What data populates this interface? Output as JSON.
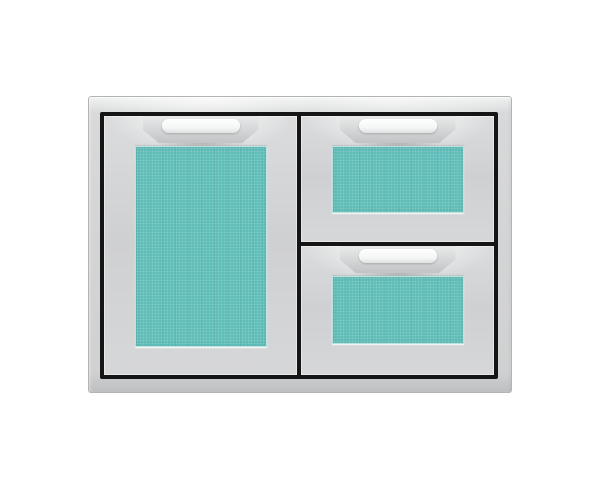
{
  "meta": {
    "type": "product-photo",
    "description": "Stainless steel door and double-drawer storage combo unit with turquoise inset front panels, photographed on a plain white background"
  },
  "colors": {
    "background": "#ffffff",
    "panel_turquoise": "#60bdb8",
    "frame_silver": "#d3d4d5",
    "face_silver": "#d0d1d2",
    "frame_outline_black": "#151515",
    "handle_silver": "#d6d7d8",
    "handle_grip_white": "#fafbfb"
  },
  "unit": {
    "id": "door-and-double-drawer-combo",
    "sections": [
      {
        "id": "storage-door",
        "panel_color": "#60bdb8",
        "handle": "chrome-top-handle"
      },
      {
        "id": "drawer-top",
        "panel_color": "#60bdb8",
        "handle": "chrome-top-handle"
      },
      {
        "id": "drawer-bottom",
        "panel_color": "#60bdb8",
        "handle": "chrome-top-handle"
      }
    ]
  }
}
